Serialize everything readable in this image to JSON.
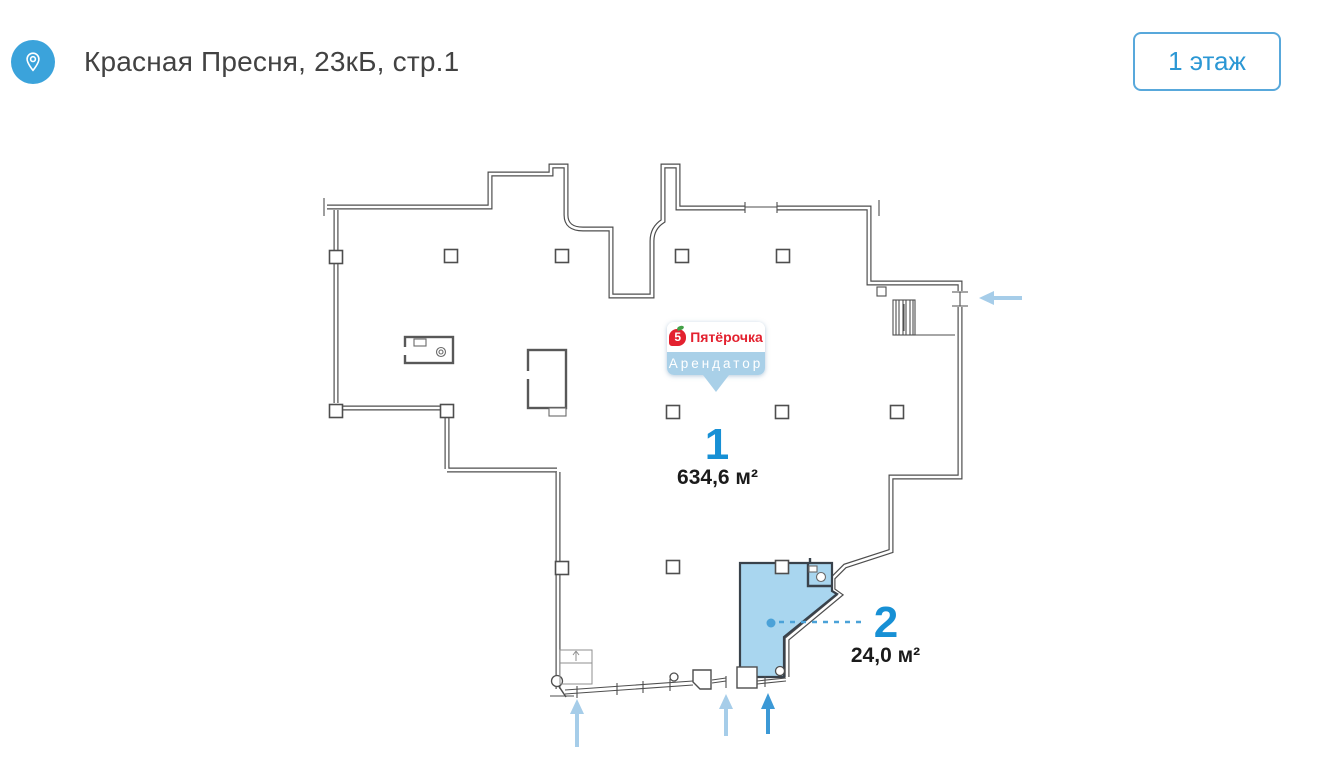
{
  "header": {
    "title": "Красная Пресня, 23кБ, стр.1",
    "floor_button_label": "1 этаж"
  },
  "tenant_badge": {
    "brand_mark": "5",
    "brand_name": "Пятёрочка",
    "label": "Арендатор"
  },
  "units": [
    {
      "number": "1",
      "area": "634,6 м²"
    },
    {
      "number": "2",
      "area": "24,0 м²"
    }
  ],
  "colors": {
    "accent_blue": "#2B97D4",
    "pin_blue": "#3BA3DB",
    "unit_fill": "#A9D6EF",
    "arrow_light": "#A6CDE9",
    "arrow_dark": "#3C99D6",
    "brand_red": "#E3212F",
    "badge_strip": "#A9D0E8",
    "wall": "#4E4E4E"
  }
}
